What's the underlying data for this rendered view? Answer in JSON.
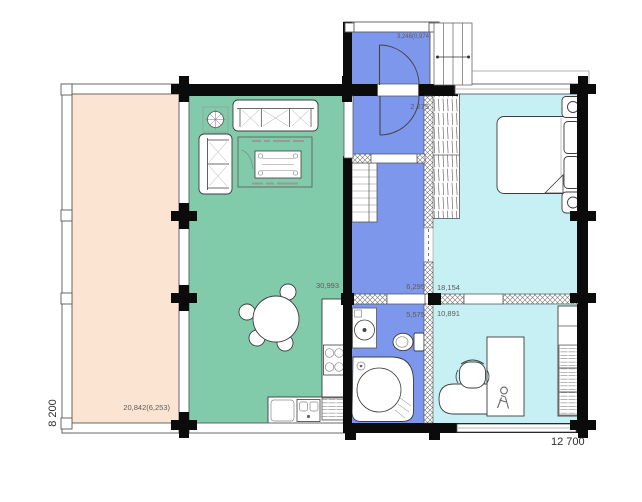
{
  "plan": {
    "type": "floor-plan",
    "dimensions": {
      "height": "8 200",
      "width": "12 700"
    },
    "colors": {
      "terrace": "#fbe4d2",
      "living": "#82cbaa",
      "wet": "#7d97ed",
      "light": "#c7f0f4",
      "wall": "#0b0b0b"
    },
    "rooms": {
      "terrace": {
        "area": "20,842(6,253)"
      },
      "living": {
        "area": "30,993"
      },
      "porch": {
        "area": "3,248(0,974)"
      },
      "hall": {
        "area": "6,295",
        "door_width": "2 275"
      },
      "bath": {
        "area": "5,575"
      },
      "bedroom": {
        "area": "18,154"
      },
      "office": {
        "area": "10,891"
      }
    }
  }
}
